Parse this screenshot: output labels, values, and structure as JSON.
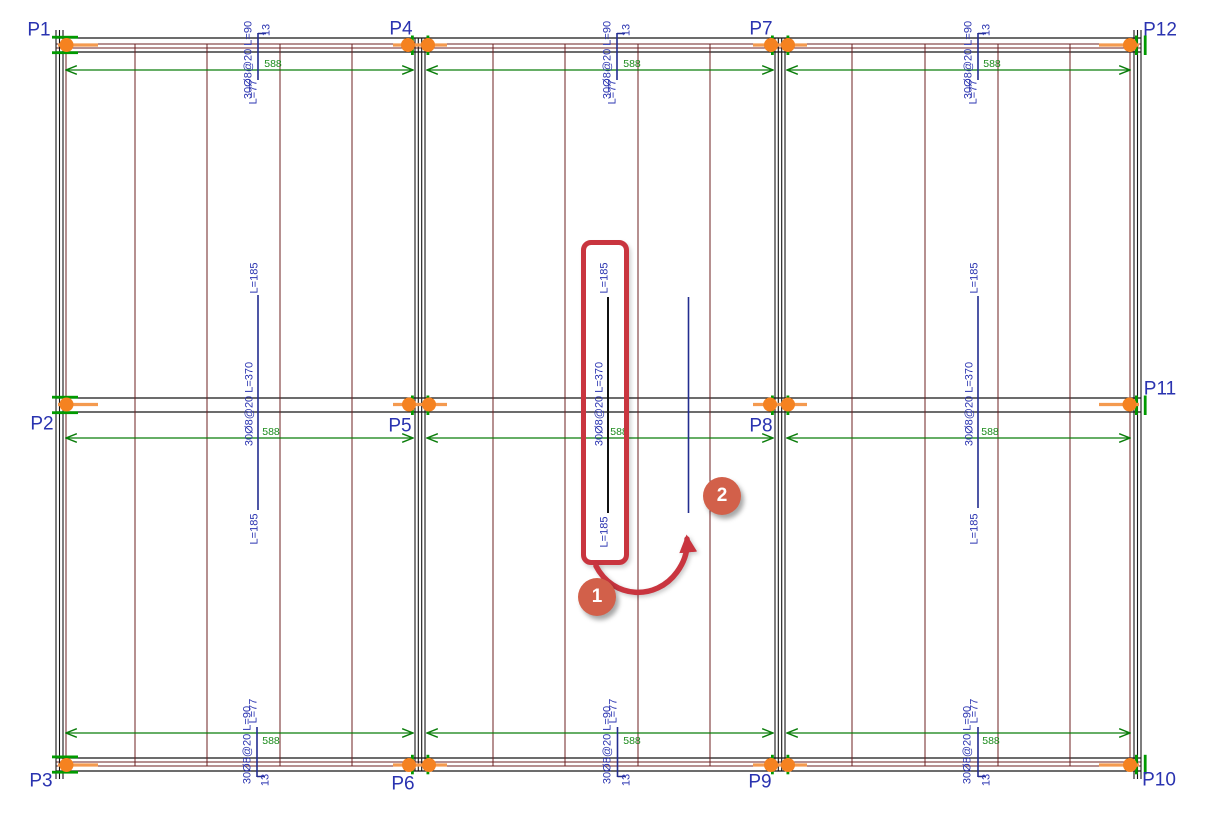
{
  "drawing": {
    "points": {
      "p1": "P1",
      "p2": "P2",
      "p3": "P3",
      "p4": "P4",
      "p5": "P5",
      "p6": "P6",
      "p7": "P7",
      "p8": "P8",
      "p9": "P9",
      "p10": "P10",
      "p11": "P11",
      "p12": "P12"
    },
    "rebar": {
      "support_band_label": "30Ø8@20 L=90",
      "mid_band_label": "30Ø8@20 L=370",
      "hook_length": "13",
      "leg_length": "L=77",
      "half_extension": "L=185",
      "span_width": "588"
    }
  },
  "tutorial": {
    "step1": "1",
    "step2": "2"
  },
  "colors": {
    "navy_text": "#2a33b0",
    "navy_line": "#232d8f",
    "black_line": "#141414",
    "maroon": "#6e2022",
    "green_line": "#0a7d0a",
    "green_text": "#1a8a1a",
    "green_tick": "#009a00",
    "orange": "#f58220",
    "orange_line": "#f49a4f",
    "accent_red": "#c9353f",
    "callout_fill": "#d2604a"
  }
}
